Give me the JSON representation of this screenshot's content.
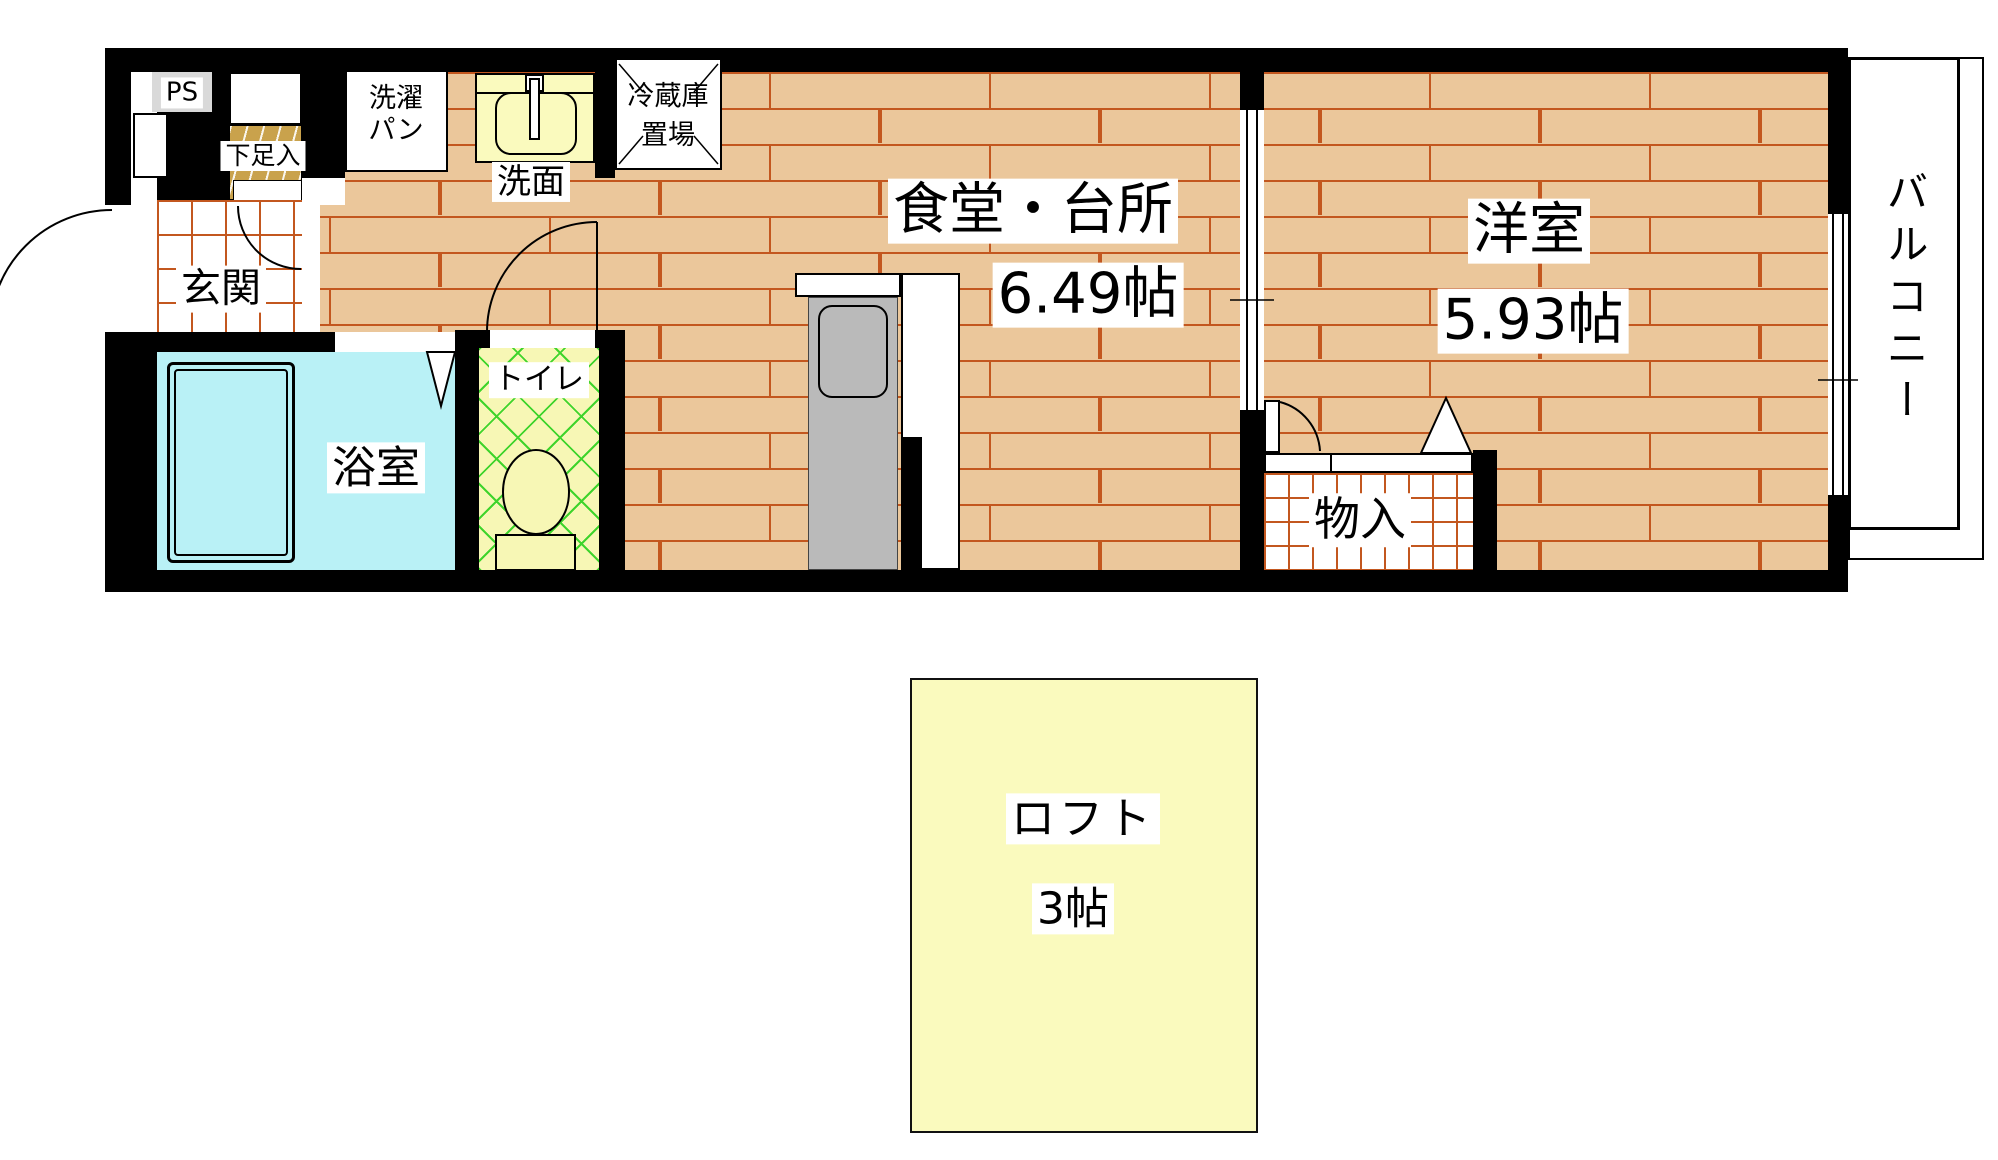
{
  "page": {
    "type": "apartment-floor-plan",
    "background": "#ffffff"
  },
  "colors": {
    "wall": "#000000",
    "floor_wood": "#ebc79b",
    "floor_joint": "#c3571f",
    "tile_line": "#c3571f",
    "bathroom_fill": "#b9f1f6",
    "toilet_fill": "#f7f7b5",
    "toilet_hatch": "#3fd42c",
    "pale_yellow": "#fafabe",
    "cabinet_fill": "#c9a24c",
    "ps_fill": "#d9d9d9",
    "counter_gray": "#bababa",
    "label_bg": "#ffffff",
    "text": "#000000"
  },
  "rooms": {
    "ps": {
      "label": "PS"
    },
    "shoe_cabinet": {
      "label": "下足入"
    },
    "laundry_pan": {
      "line1": "洗濯",
      "line2": "パン"
    },
    "washbasin": {
      "label": "洗面"
    },
    "fridge_space": {
      "line1": "冷蔵庫",
      "line2": "置場"
    },
    "entrance": {
      "label": "玄関"
    },
    "bathroom": {
      "label": "浴室"
    },
    "toilet": {
      "label": "トイレ"
    },
    "dining_kitchen": {
      "label": "食堂・台所",
      "size": "6.49帖"
    },
    "western_room": {
      "label": "洋室",
      "size": "5.93帖"
    },
    "storage": {
      "label": "物入"
    },
    "balcony": {
      "label": "バルコニー"
    },
    "loft": {
      "label": "ロフト",
      "size": "3帖"
    }
  }
}
